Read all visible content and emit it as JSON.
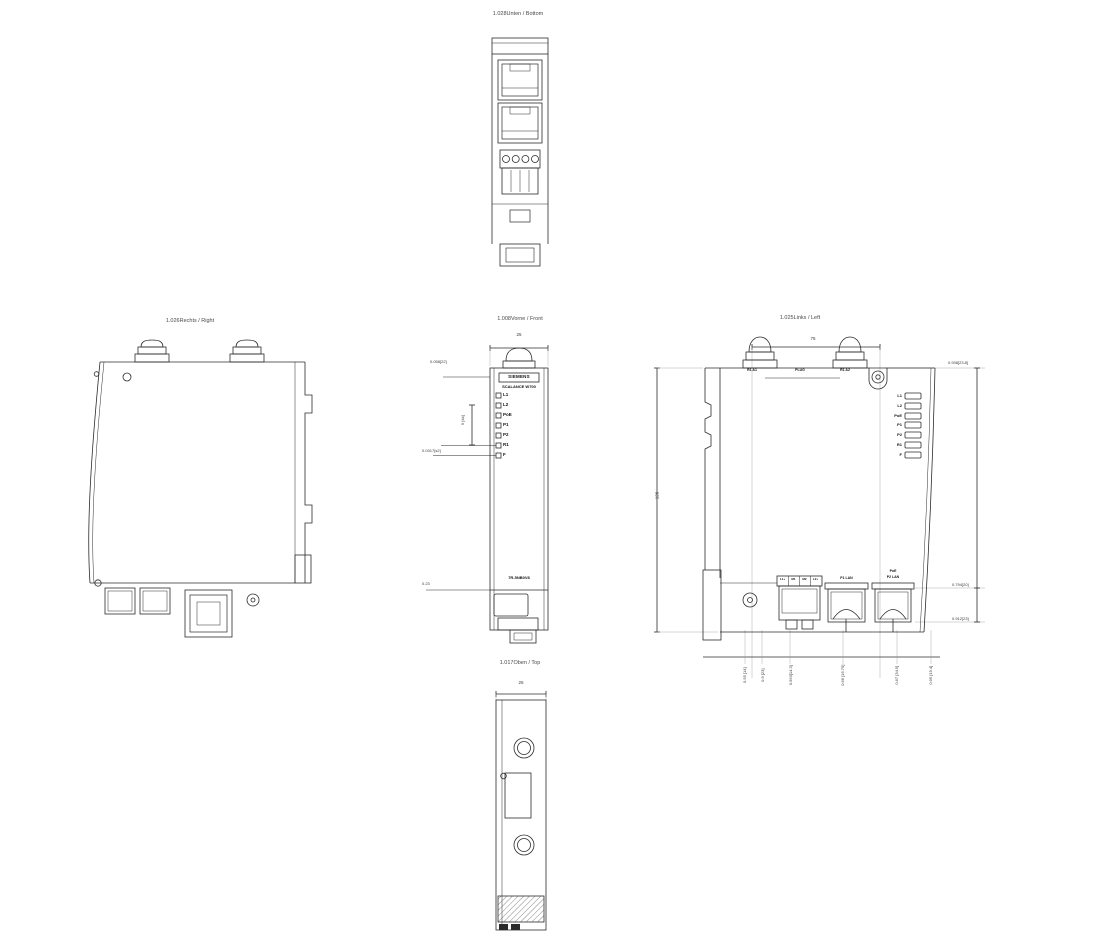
{
  "drawing": {
    "subject": "SCALANCE W700 dimensional drawing"
  },
  "views": {
    "bottom": {
      "title": "1.028Unten / Bottom"
    },
    "right": {
      "title": "1.026Rechts / Right"
    },
    "front": {
      "title": "1.008Vorne / Front",
      "dim_width": "25",
      "brand": "SIEMENS",
      "product": "SCALANCE W700",
      "leds": [
        "L1",
        "L2",
        "PoE",
        "P1",
        "P2",
        "R1",
        "F"
      ],
      "product_code": "7R-5NB0V8",
      "dim_top_left": "0.058[22]",
      "dim_led_pitch": "9 [4x]",
      "dim_mid_left": "0.0317[s2]",
      "dim_bottom_left": "0.23"
    },
    "left": {
      "title": "1.025Links / Left",
      "dim_top": "75",
      "dim_height": "128",
      "antenna1_label": "R1 A1",
      "plug_label": "PLUG",
      "antenna2_label": "R1 A2",
      "leds": [
        "L1",
        "L2",
        "PoE",
        "P1",
        "P2",
        "R1",
        "F"
      ],
      "terminal_cells": [
        "L1+",
        "M1",
        "M2",
        "L2+"
      ],
      "port1_label": "P1 LAN",
      "port2_label_line1": "PoE",
      "port2_label_line2": "P2 LAN",
      "dim_right_top": "0.938[23.8]",
      "dim_right_mid": "0.794[20]",
      "dim_right_bottom": "0.912[23]",
      "dims_bottom": [
        "0.55 [14]",
        "0.9 [23]",
        "0.563[14.3]",
        "0.66 [16.75]",
        "0.67 [34.5]",
        "0.95 [19.4]"
      ]
    },
    "top": {
      "title": "1.017Oben / Top",
      "dim_width": "25"
    }
  },
  "colors": {
    "line": "#2b2b2b",
    "thin_line": "#999999",
    "text": "#3a3a3a"
  }
}
